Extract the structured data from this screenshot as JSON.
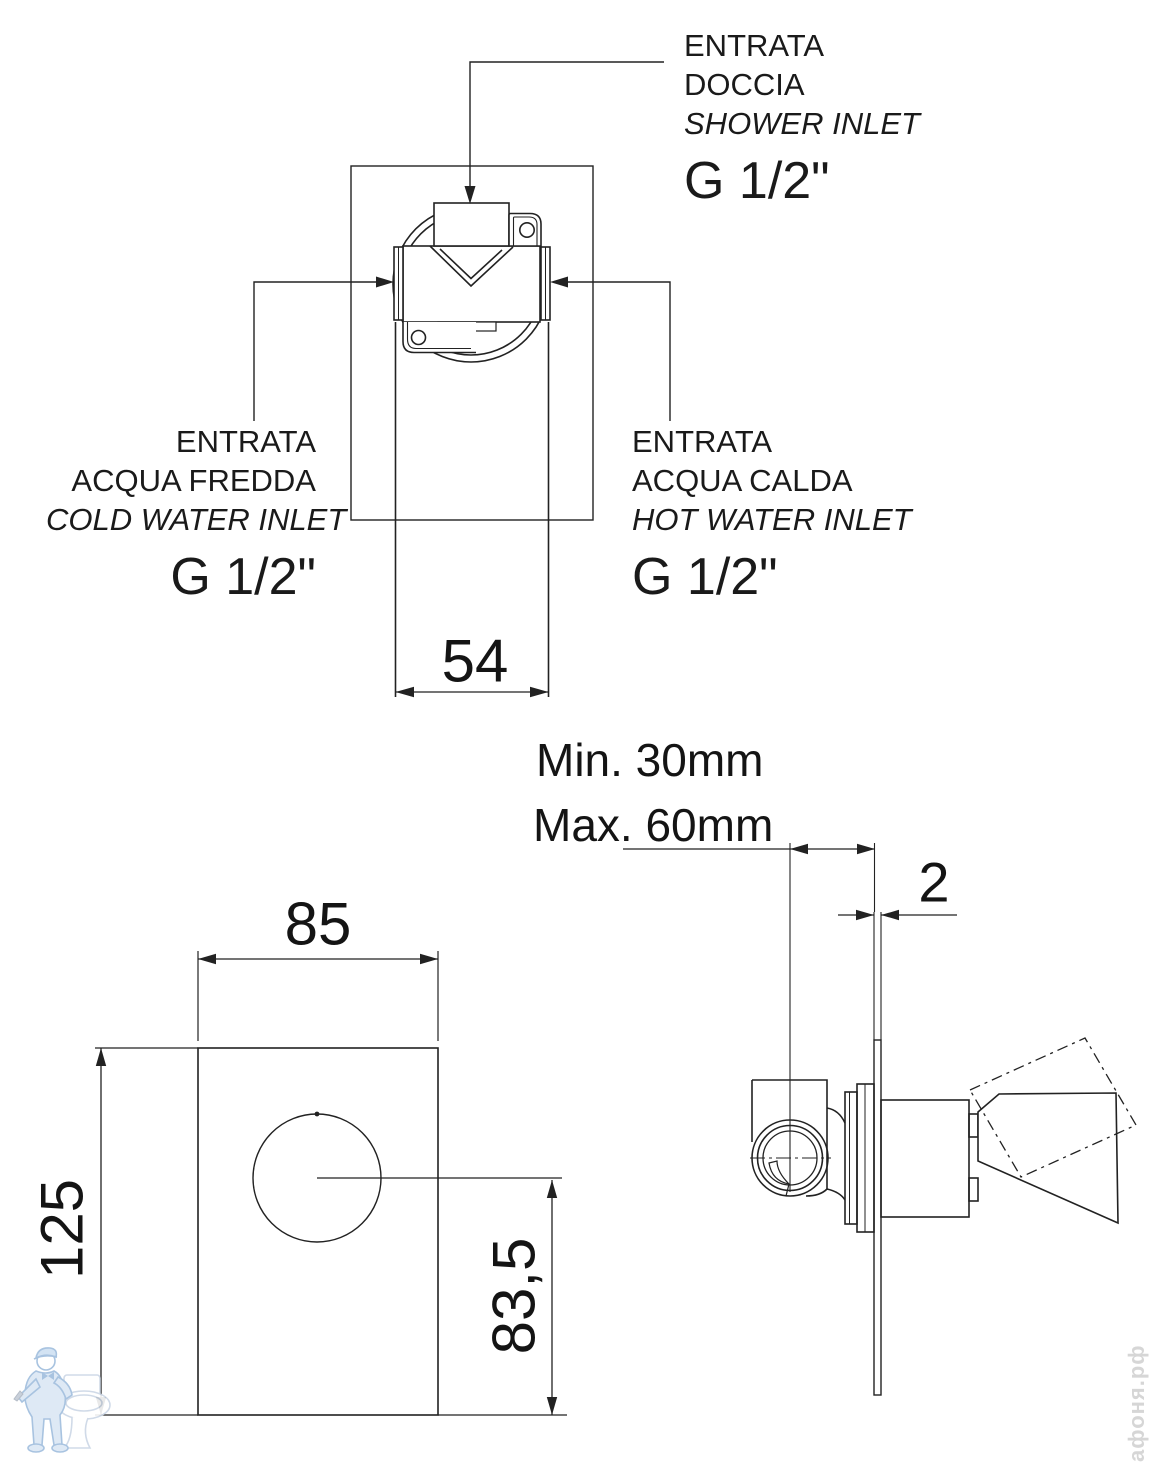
{
  "top_view": {
    "shower_inlet": {
      "line1": "ENTRATA",
      "line2": "DOCCIA",
      "line3": "SHOWER INLET",
      "thread": "G 1/2\""
    },
    "cold_inlet": {
      "line1": "ENTRATA",
      "line2": "ACQUA FREDDA",
      "line3": "COLD WATER INLET",
      "thread": "G 1/2\""
    },
    "hot_inlet": {
      "line1": "ENTRATA",
      "line2": "ACQUA CALDA",
      "line3": "HOT WATER INLET",
      "thread": "G 1/2\""
    },
    "dim_width": "54"
  },
  "front_view": {
    "dim_width": "85",
    "dim_height": "125",
    "dim_center_to_bottom": "83,5"
  },
  "side_view": {
    "dim_depth_min": "Min. 30mm",
    "dim_depth_max": "Max. 60mm",
    "dim_plate_thickness": "2"
  },
  "watermarks": {
    "site_text": "афоня.рф"
  },
  "colors": {
    "line": "#222222",
    "watermark_blue": "#9fbddd",
    "watermark_fill": "#dbe7f5",
    "watermark_text": "#d6d6d6"
  }
}
